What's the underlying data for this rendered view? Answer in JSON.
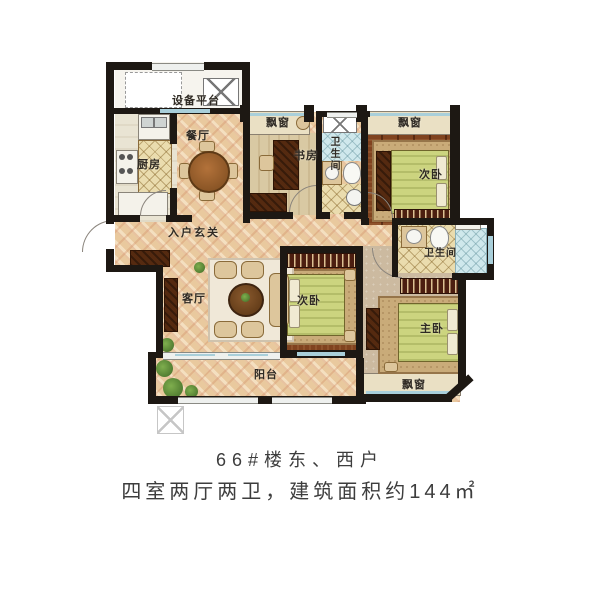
{
  "floorplan": {
    "labels": {
      "equipment_platform": "设备平台",
      "dining_room": "餐厅",
      "kitchen": "厨房",
      "bay_window": "飘窗",
      "study": "书房",
      "bathroom": "卫生间",
      "secondary_bedroom": "次卧",
      "entry_foyer": "入户玄关",
      "living_room": "客厅",
      "master_bedroom": "主卧",
      "balcony": "阳台"
    },
    "colors": {
      "wall": "#1d1813",
      "floor_beige": "#e9c99e",
      "floor_wood": "#80431f",
      "floor_tile": "#eadcae",
      "bedding_green": "#ccd47f",
      "window_glass": "#a9cfda"
    }
  },
  "caption": {
    "line1": "66#楼东、西户",
    "line2": "四室两厅两卫，建筑面积约144㎡"
  }
}
